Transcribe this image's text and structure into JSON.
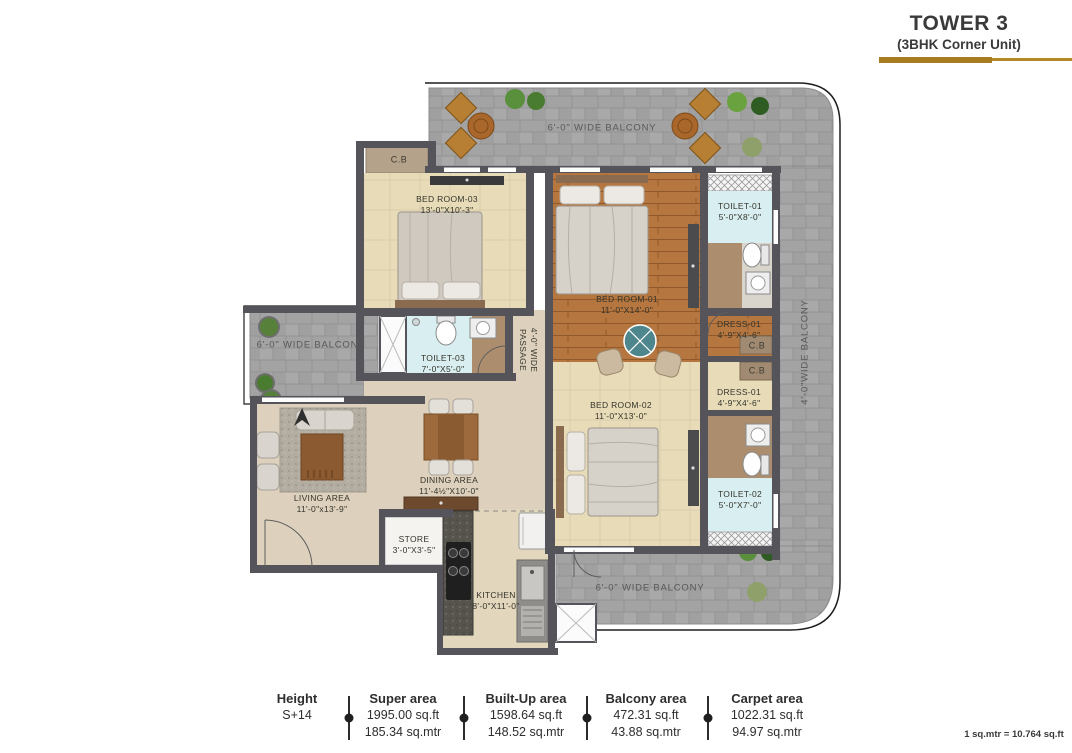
{
  "header": {
    "title": "TOWER 3",
    "subtitle": "(3BHK Corner Unit)"
  },
  "colors": {
    "accent_gold": "#a87c20",
    "wall": "#54545a",
    "paver_gray": "#a4a4a4",
    "wood_floor": "#b5773f",
    "beige_floor": "#e8dcb8",
    "toilet_blue": "#d9eef0"
  },
  "plan": {
    "balconies": {
      "top": "6'-0\" WIDE BALCONY",
      "left": "6'-0\" WIDE BALCONY",
      "bottom": "6'-0\" WIDE BALCONY",
      "right": "4'-0\"WIDE BALCONY"
    },
    "passage": {
      "line1": "4'-0\" WIDE",
      "line2": "PASSAGE"
    },
    "closets": {
      "cb_top": "C.B",
      "cb_mid1": "C.B",
      "cb_mid2": "C.B"
    },
    "rooms": {
      "bedroom3": {
        "name": "BED ROOM-03",
        "dims": "13'-0\"X10'-3\""
      },
      "bedroom1": {
        "name": "BED ROOM-01",
        "dims": "11'-0\"X14'-0\""
      },
      "bedroom2": {
        "name": "BED ROOM-02",
        "dims": "11'-0\"X13'-0\""
      },
      "toilet1": {
        "name": "TOILET-01",
        "dims": "5'-0\"X8'-0\""
      },
      "toilet2": {
        "name": "TOILET-02",
        "dims": "5'-0\"X7'-0\""
      },
      "toilet3": {
        "name": "TOILET-03",
        "dims": "7'-0\"X5'-0\""
      },
      "dress1": {
        "name": "DRESS-01",
        "dims": "4'-9\"X4'-6\""
      },
      "dress2": {
        "name": "DRESS-01",
        "dims": "4'-9\"X4'-6\""
      },
      "living": {
        "name": "LIVING AREA",
        "dims": "11'-0\"x13'-9\""
      },
      "dining": {
        "name": "DINING AREA",
        "dims": "11'-4½\"X10'-0\""
      },
      "store": {
        "name": "STORE",
        "dims": "3'-0\"X3'-5\""
      },
      "kitchen": {
        "name": "KITCHEN",
        "dims": "8'-0\"X11'-0\""
      }
    }
  },
  "stats": {
    "items": [
      {
        "label": "Height",
        "line1": "S+14",
        "line2": ""
      },
      {
        "label": "Super area",
        "line1": "1995.00 sq.ft",
        "line2": "185.34 sq.mtr"
      },
      {
        "label": "Built-Up area",
        "line1": "1598.64 sq.ft",
        "line2": "148.52 sq.mtr"
      },
      {
        "label": "Balcony area",
        "line1": "472.31 sq.ft",
        "line2": "43.88 sq.mtr"
      },
      {
        "label": "Carpet area",
        "line1": "1022.31 sq.ft",
        "line2": "94.97 sq.mtr"
      }
    ],
    "footnote": "1 sq.mtr = 10.764 sq.ft"
  }
}
